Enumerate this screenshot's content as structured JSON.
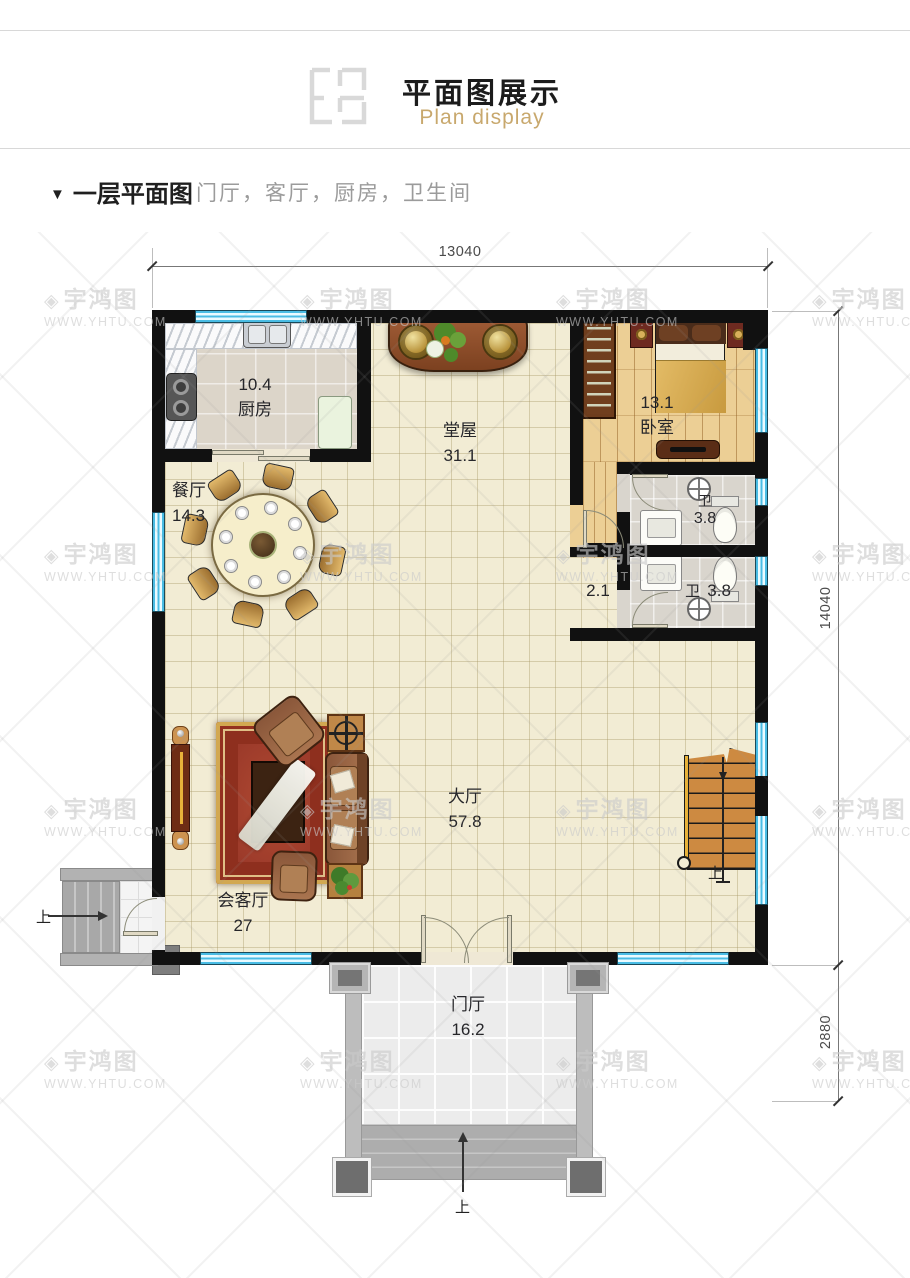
{
  "header": {
    "title": "平面图展示",
    "subtitle": "Plan display"
  },
  "section": {
    "marker": "▼",
    "title": "一层平面图",
    "subtitle": "门厅，客厅，厨房，卫生间"
  },
  "dims": {
    "width": "13040",
    "height": "14040",
    "porch_depth": "2880"
  },
  "rooms": [
    {
      "id": "kitchen",
      "name": "厨房",
      "area": "10.4"
    },
    {
      "id": "dining",
      "name": "餐厅",
      "area": "14.3"
    },
    {
      "id": "tangwu",
      "name": "堂屋",
      "area": "31.1"
    },
    {
      "id": "bedroom",
      "name": "卧室",
      "area": "13.1"
    },
    {
      "id": "bath-1",
      "name": "卫",
      "area": "3.8"
    },
    {
      "id": "bath-2",
      "name": "卫",
      "area": "3.8"
    },
    {
      "id": "corridor",
      "name": "",
      "area": "2.1"
    },
    {
      "id": "hall",
      "name": "大厅",
      "area": "57.8"
    },
    {
      "id": "reception",
      "name": "会客厅",
      "area": "27"
    },
    {
      "id": "foyer",
      "name": "门厅",
      "area": "16.2"
    }
  ],
  "annotations": {
    "up": "上"
  },
  "watermark": {
    "logo_glyph": "◈",
    "brand": "宇鸿图",
    "url": "WWW.YHTU.COM"
  },
  "colors": {
    "wall": "#111111",
    "window_blue": "#49bce4",
    "floor_cream": "#f2ecd4",
    "accent_gold": "#c8a86d"
  }
}
